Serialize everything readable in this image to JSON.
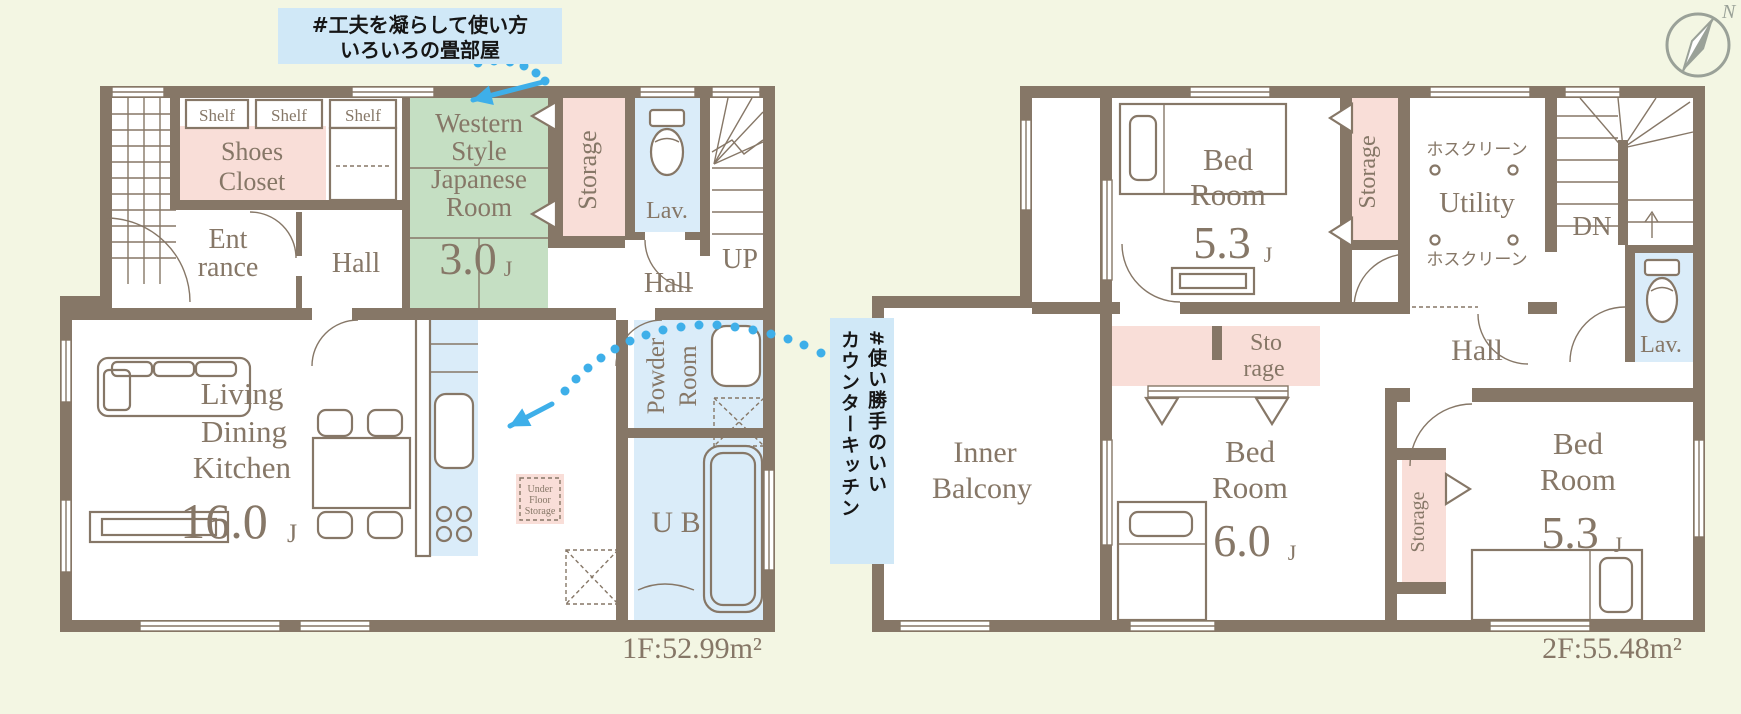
{
  "colors": {
    "bg": "#f3f6e3",
    "wall": "#867767",
    "pink": "#f9ded8",
    "green": "#c5dfc3",
    "blue": "#daecf9",
    "abg": "#d0e8f7",
    "arrow": "#3eafe9",
    "compass": "#9aa198"
  },
  "annotations": {
    "tatami_line1": "#工夫を凝らして使い方",
    "tatami_line2": "いろいろの畳部屋",
    "kitchen_line1": "#使い勝手のいい",
    "kitchen_line2": "カウンターキッチン"
  },
  "compass": {
    "north": "N"
  },
  "f1": {
    "area": "1F:52.99m²",
    "shelf1": "Shelf",
    "shelf2": "Shelf",
    "shelf3": "Shelf",
    "shoes1": "Shoes",
    "shoes2": "Closet",
    "ent1": "Ent",
    "ent2": "rance",
    "hall_a": "Hall",
    "hall_b": "Hall",
    "west1": "Western",
    "west2": "Style",
    "west3": "Japanese",
    "west4": "Room",
    "west_size": "3.0",
    "west_unit": "J",
    "storage": "Storage",
    "lav": "Lav.",
    "up": "UP",
    "ldk1": "Living",
    "ldk2": "Dining",
    "ldk3": "Kitchen",
    "ldk_size": "16.0",
    "ldk_unit": "J",
    "powder1": "Powder",
    "powder2": "Room",
    "ub": "U B",
    "ufs1": "Under",
    "ufs2": "Floor",
    "ufs3": "Storage"
  },
  "f2": {
    "area": "2F:55.48m²",
    "bed1a": "Bed",
    "bed1b": "Room",
    "bed1_size": "5.3",
    "bed1_unit": "J",
    "storage1": "Storage",
    "hos1": "ホスクリーン",
    "utility": "Utility",
    "hos2": "ホスクリーン",
    "dn": "DN",
    "lav": "Lav.",
    "hall": "Hall",
    "sto1": "Sto",
    "sto2": "rage",
    "inner1": "Inner",
    "inner2": "Balcony",
    "bed2a": "Bed",
    "bed2b": "Room",
    "bed2_size": "6.0",
    "bed2_unit": "J",
    "storage3": "Storage",
    "bed3a": "Bed",
    "bed3b": "Room",
    "bed3_size": "5.3",
    "bed3_unit": "J"
  }
}
